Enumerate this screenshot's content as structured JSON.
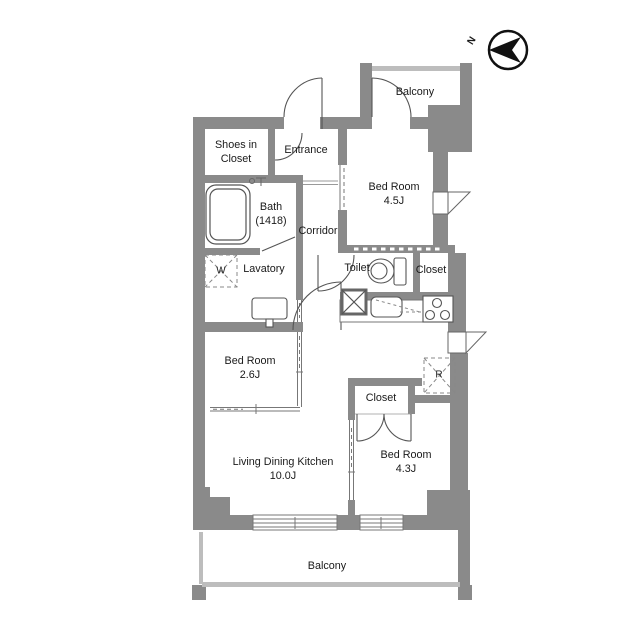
{
  "plan_title": "apartment-floor-plan",
  "colors": {
    "wall": "#8a8a8a",
    "railing": "#bdbdbd",
    "fixture_line": "#555555",
    "text": "#1a1a1a",
    "background": "#ffffff"
  },
  "compass": {
    "label": "N"
  },
  "rooms": {
    "balcony_top": {
      "name": "Balcony"
    },
    "shoes_in_closet": {
      "line1": "Shoes in",
      "line2": "Closet"
    },
    "entrance": {
      "name": "Entrance"
    },
    "bath": {
      "name": "Bath",
      "size": "(1418)"
    },
    "corridor": {
      "name": "Corridor"
    },
    "bedroom_main": {
      "name": "Bed Room",
      "size": "4.5J"
    },
    "washer_space": {
      "symbol": "W"
    },
    "lavatory": {
      "name": "Lavatory"
    },
    "toilet": {
      "name": "Toilet"
    },
    "closet_hall": {
      "name": "Closet"
    },
    "bedroom_small": {
      "name": "Bed Room",
      "size": "2.6J"
    },
    "refrigerator_space": {
      "symbol": "R"
    },
    "closet_bedroom": {
      "name": "Closet"
    },
    "ldk": {
      "name": "Living Dining Kitchen",
      "size": "10.0J"
    },
    "bedroom_south": {
      "name": "Bed Room",
      "size": "4.3J"
    },
    "balcony_bottom": {
      "name": "Balcony"
    }
  }
}
